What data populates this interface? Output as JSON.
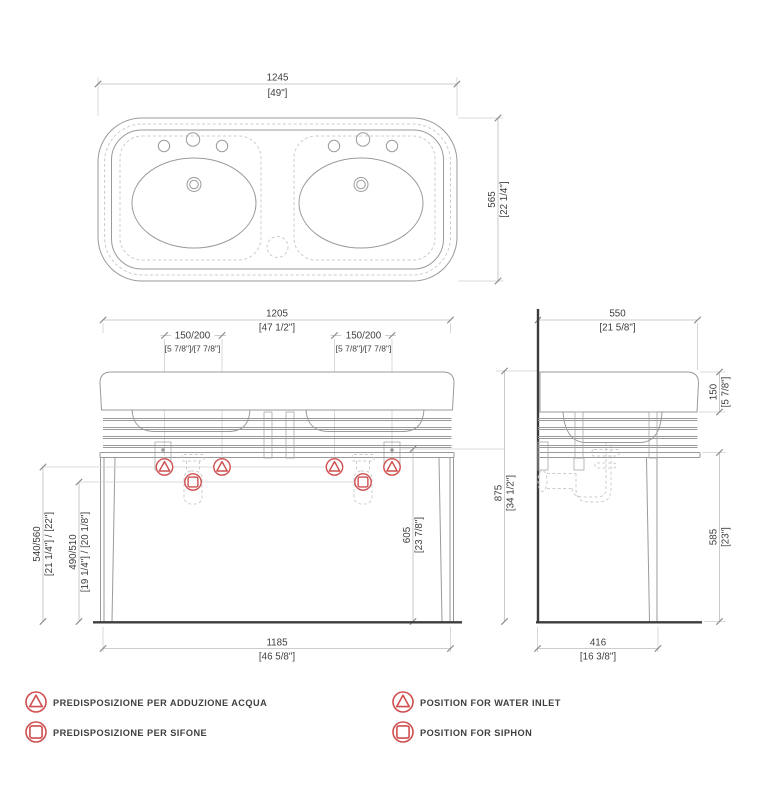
{
  "drawing": {
    "title": "double-console-washbasin-technical-drawing",
    "colors": {
      "object_line": "#9a9a9a",
      "dimension_line": "#bdbdbd",
      "dark_line": "#3c3c3c",
      "symbol_red": "#cf4f4f",
      "text": "#3d3d3d"
    }
  },
  "top_view": {
    "dim_width": {
      "mm": "1245",
      "in": "[49\"]"
    },
    "dim_depth": {
      "mm": "565",
      "in": "[22 1/4\"]"
    }
  },
  "front_view": {
    "dim_width": {
      "mm": "1205",
      "in": "[47 1/2\"]"
    },
    "dim_tap_left": {
      "mm": "150/200",
      "in": "[5 7/8\"]/[7 7/8\"]"
    },
    "dim_tap_right": {
      "mm": "150/200",
      "in": "[5 7/8\"]/[7 7/8\"]"
    },
    "dim_inlet_height": {
      "mm": "540/560",
      "in": "[21 1/4\"] / [22\"]"
    },
    "dim_siphon_height": {
      "mm": "490/510",
      "in": "[19 1/4\"] / [20 1/8\"]"
    },
    "dim_frame_height": {
      "mm": "605",
      "in": "[23 7/8\"]"
    },
    "dim_total_height": {
      "mm": "875",
      "in": "[34 1/2\"]"
    },
    "dim_base_width": {
      "mm": "1185",
      "in": "[46 5/8\"]"
    }
  },
  "side_view": {
    "dim_depth": {
      "mm": "550",
      "in": "[21 5/8\"]"
    },
    "dim_rim_height": {
      "mm": "150",
      "in": "[5 7/8\"]"
    },
    "dim_leg_height": {
      "mm": "585",
      "in": "[23\"]"
    },
    "dim_base_depth": {
      "mm": "416",
      "in": "[16 3/8\"]"
    }
  },
  "legend": {
    "items": [
      {
        "symbol": "water-inlet",
        "label_it": "PREDISPOSIZIONE PER ADDUZIONE ACQUA",
        "label_en": "POSITION FOR WATER INLET"
      },
      {
        "symbol": "siphon",
        "label_it": "PREDISPOSIZIONE PER SIFONE",
        "label_en": "POSITION FOR SIPHON"
      }
    ]
  }
}
